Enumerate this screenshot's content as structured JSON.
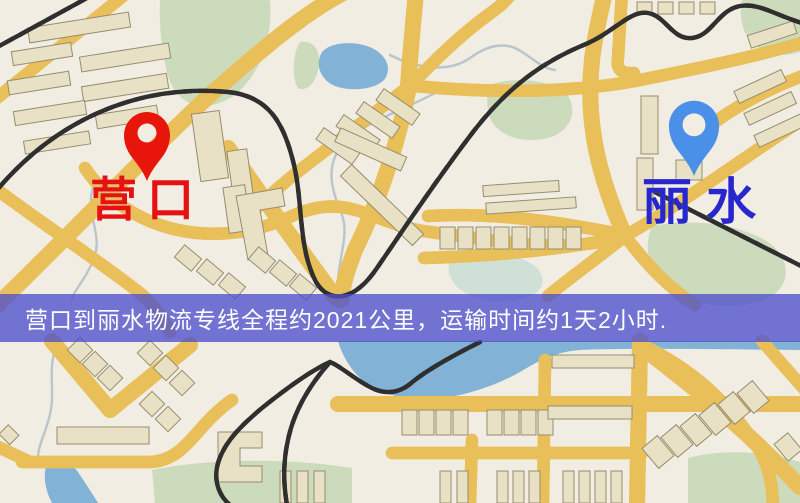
{
  "banner": {
    "text": "营口到丽水物流专线全程约2021公里，运输时间约1天2小时."
  },
  "route": {
    "origin": "营口",
    "destination": "丽水",
    "distance_text": "约2021公里",
    "duration_text": "约1天2小时"
  },
  "map": {
    "markers": {
      "origin": {
        "label": "营口",
        "icon": "map-pin-icon"
      },
      "destination": {
        "label": "丽水",
        "icon": "map-pin-icon"
      }
    }
  },
  "theme": {
    "background": "#f2ede3",
    "road": "#f6d272",
    "road_casing": "#e8bf58",
    "building": "#e9e1c6",
    "building_outline": "#968d6e",
    "park": "#ccdbbb",
    "water": "#82b3d6",
    "river": "#b9c5cc",
    "railway": "#2f2f2f",
    "marker_red": "#e8150b",
    "marker_blue": "#4a90e8",
    "label_red": "#e41212",
    "label_blue": "#2727cd",
    "banner_bg": "rgba(77,79,204,0.78)",
    "banner_text": "#ffffff"
  }
}
